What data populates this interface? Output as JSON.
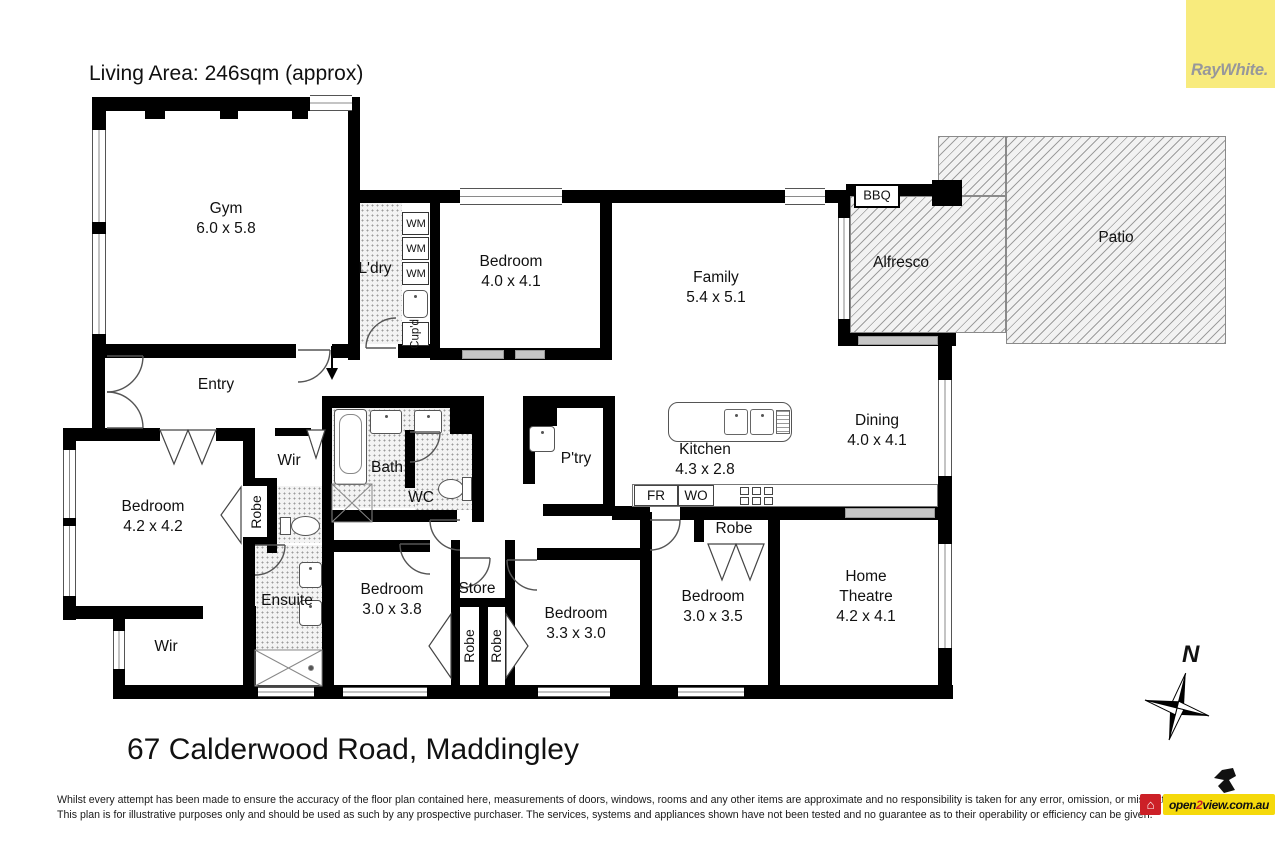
{
  "meta": {
    "living_area": "Living Area: 246sqm (approx)"
  },
  "brand": {
    "name": "RayWhite.",
    "bg": "#F8EB7D",
    "text_color": "#97979B"
  },
  "rooms": {
    "gym": {
      "name": "Gym",
      "dims": "6.0 x 5.8"
    },
    "ldry": {
      "name": "L'dry"
    },
    "wm": "WM",
    "cupd": "Cup'd",
    "bedroom1": {
      "name": "Bedroom",
      "dims": "4.0 x 4.1"
    },
    "family": {
      "name": "Family",
      "dims": "5.4 x 5.1"
    },
    "bbq": "BBQ",
    "alfresco": "Alfresco",
    "patio": "Patio",
    "entry": "Entry",
    "dining": {
      "name": "Dining",
      "dims": "4.0 x 4.1"
    },
    "kitchen": {
      "name": "Kitchen",
      "dims": "4.3 x 2.8"
    },
    "ptry": "P'try",
    "fr": "FR",
    "wo": "WO",
    "wir_top": "Wir",
    "bath": "Bath",
    "wc": "WC",
    "master": {
      "name": "Bedroom",
      "dims": "4.2 x 4.2"
    },
    "robe": "Robe",
    "ensuite": "Ensuite",
    "wir_bottom": "Wir",
    "bedroom2": {
      "name": "Bedroom",
      "dims": "3.0 x 3.8"
    },
    "store": "Store",
    "bedroom3": {
      "name": "Bedroom",
      "dims": "3.3 x 3.0"
    },
    "bedroom4": {
      "name": "Bedroom",
      "dims": "3.0 x 3.5"
    },
    "theatre": {
      "line1": "Home",
      "line2": "Theatre",
      "dims": "4.2 x 4.1"
    }
  },
  "compass": {
    "north": "N"
  },
  "footer": {
    "address": "67 Calderwood Road, Maddingley",
    "disclaimer1": "Whilst every attempt has been made to ensure the accuracy of the floor plan contained here, measurements of doors, windows, rooms and any other items are approximate and no responsibility is taken for any error, omission, or mis-statement.",
    "disclaimer2": "This plan is for illustrative purposes only and should be used as such by any prospective purchaser. The services, systems and appliances shown have not been tested and no guarantee as to their operability or efficiency can be given.",
    "watermark": {
      "pre": "open",
      "num": "2",
      "post": "view.com.au"
    },
    "house_icon": "⌂"
  }
}
